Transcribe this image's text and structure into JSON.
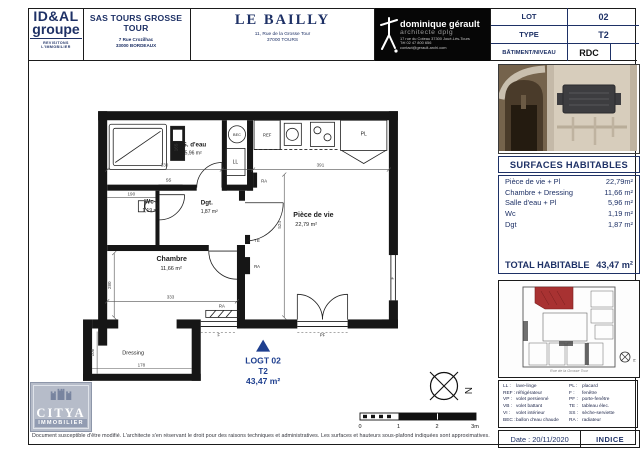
{
  "header": {
    "idal": {
      "name_top": "ID&AL",
      "name_bottom": "groupe",
      "tagline": "REVISITONS L'IMMOBILIER"
    },
    "company": {
      "name": "SAS TOURS GROSSE TOUR",
      "address1": "7 Rue Crozilhac",
      "address2": "33000 BORDEAUX"
    },
    "project": {
      "name": "LE BAILLY",
      "address1": "11, Rue de la Grosse Tour",
      "address2": "37000 TOURS"
    },
    "architect": {
      "name": "dominique gérault",
      "title": "architecte dplg",
      "address": "17 rue du Coteau 37300 Joué-Lès-Tours",
      "phone": "Tél 02 47 800 656",
      "email": "contact@gerault-archi.com"
    },
    "lot": {
      "rows": [
        {
          "label": "LOT",
          "value": "02"
        },
        {
          "label": "TYPE",
          "value": "T2"
        },
        {
          "label": "BÂTIMENT/NIVEAU",
          "value": "RDC"
        }
      ]
    }
  },
  "sidebar": {
    "surfaces": {
      "title": "SURFACES HABITABLES",
      "rows": [
        {
          "label": "Pièce de vie + Pl",
          "value": "22,79m²"
        },
        {
          "label": "Chambre + Dressing",
          "value": "11,66 m²"
        },
        {
          "label": "Salle d'eau + Pl",
          "value": "5,96 m²"
        },
        {
          "label": "Wc",
          "value": "1,19 m²"
        },
        {
          "label": "Dgt",
          "value": "1,87 m²"
        }
      ],
      "total_label": "TOTAL HABITABLE",
      "total_value": "43,47 m²"
    },
    "keyplan": {
      "caption": "Rue de la Grosse Tour"
    },
    "legend": {
      "left": [
        {
          "abbr": "LL",
          "label": "lave-linge"
        },
        {
          "abbr": "REF",
          "label": "réfrigérateur"
        },
        {
          "abbr": "VP",
          "label": "volet persienné"
        },
        {
          "abbr": "VB",
          "label": "volet battant"
        },
        {
          "abbr": "VI",
          "label": "volet intérieur"
        },
        {
          "abbr": "BEC",
          "label": "ballon d'eau chaude"
        }
      ],
      "right": [
        {
          "abbr": "PL",
          "label": "placard"
        },
        {
          "abbr": "F",
          "label": "fenêtre"
        },
        {
          "abbr": "PF",
          "label": "porte-fenêtre"
        },
        {
          "abbr": "TE",
          "label": "tableau élec."
        },
        {
          "abbr": "SS",
          "label": "sèche-serviette"
        },
        {
          "abbr": "RA",
          "label": "radiateur"
        }
      ]
    },
    "date": "Date : 20/11/2020",
    "indice": "INDICE"
  },
  "plan": {
    "rooms": {
      "sdeau": {
        "name": "S. d'eau",
        "area": "5,96 m²"
      },
      "wc": {
        "name": "Wc",
        "area": "1,19 m²"
      },
      "dgt": {
        "name": "Dgt.",
        "area": "1,87 m²"
      },
      "sejour": {
        "name": "Pièce de vie",
        "area": "22,79 m²"
      },
      "chambre": {
        "name": "Chambre",
        "area": "11,66 m²"
      },
      "dressing": {
        "name": "Dressing"
      }
    },
    "logt": {
      "line1": "LOGT 02",
      "line2": "T2",
      "line3": "43,47 m²"
    },
    "fixtures": {
      "bec": "BEC",
      "ll": "LL",
      "ref": "REF",
      "ra": "RA",
      "ss": "SS",
      "te": "TE",
      "pl": "PL",
      "f": "F",
      "pf": "PF"
    },
    "dims": {
      "d330": "330",
      "d391": "391",
      "d524": "524",
      "d333": "333",
      "d280": "280",
      "d190": "190",
      "d165": "165",
      "d108": "108",
      "d178": "178"
    },
    "north_label": "N",
    "scale_ticks": [
      "0",
      "1",
      "2",
      "3m"
    ]
  },
  "footer": {
    "citya_name": "CITYA",
    "citya_sub": "IMMOBILIER",
    "disclaimer": "Document susceptible d'être modifié. L'architecte s'en réservant le droit pour des raisons techniques et administratives. Les surfaces et hauteurs sous-plafond indiquées sont approximatives."
  },
  "colors": {
    "navy": "#1e3166",
    "logt_blue": "#1e3f8f",
    "keyplan_red": "#a83232",
    "wall_black": "#161616"
  }
}
